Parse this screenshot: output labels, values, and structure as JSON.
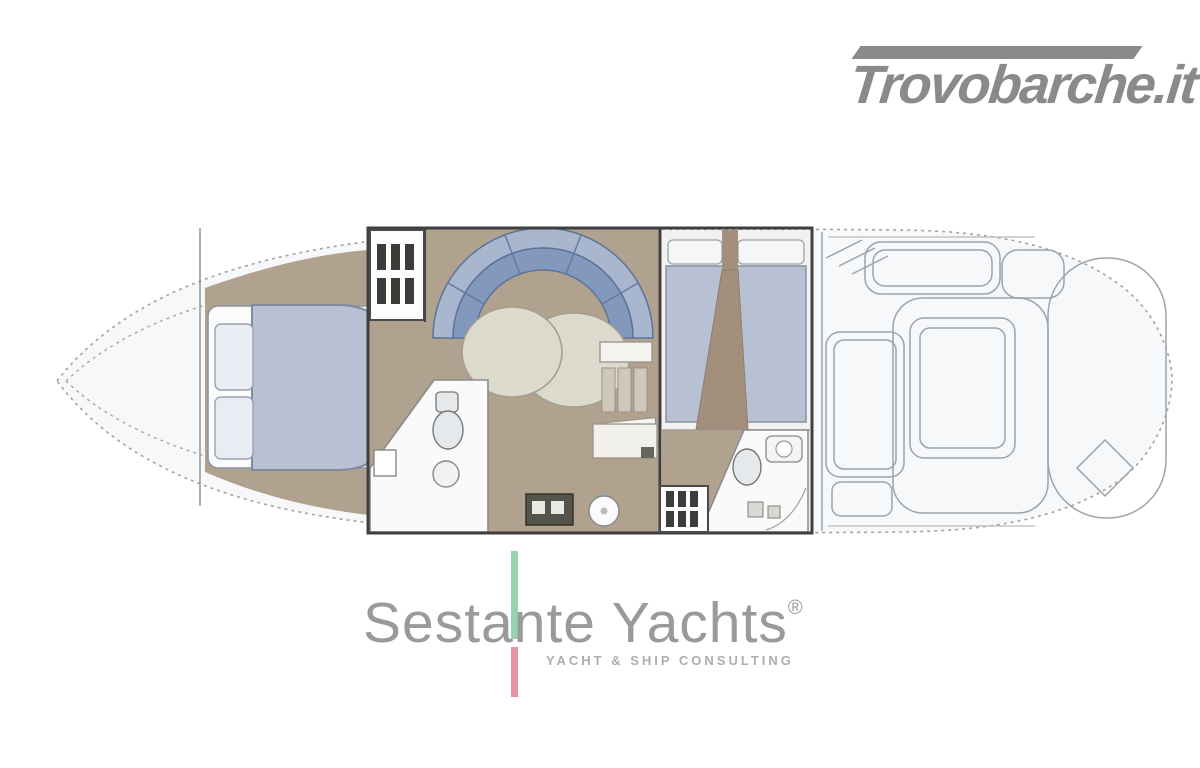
{
  "header": {
    "logo_text": "Trovobarche.it",
    "logo_color": "#8a8a8a"
  },
  "floorplan": {
    "type": "motor-yacht-deck-plan",
    "zones": [
      "bow-deck",
      "forward-cabin-double-berth",
      "salon-u-dinette-with-table",
      "forward-head",
      "galley",
      "companionway-steps",
      "mid-cabin-twin-berths",
      "aft-head",
      "cockpit-seating",
      "engine-hatch-sunpad",
      "stern-swim-platform"
    ],
    "colors": {
      "hull_fill": "#f7f8f9",
      "outline": "#a3a3a3",
      "wall": "#3f3f3f",
      "line": "#9ba3ac",
      "floor_tan": "#b0a28f",
      "floor_tan_dark": "#a2907c",
      "upholstery_blue": "#8298bc",
      "upholstery_blue_light": "#a8b6ce",
      "mattress_blue": "#b8c0d4",
      "pillow": "#e9edf3",
      "table_cream": "#dcdacd",
      "fixture_white": "#fafafa",
      "fixture_gray": "#e6e9ec",
      "cabinet_tan": "#cfc8ba",
      "stove_dark": "#55544a",
      "grid_dark": "#3c3c38",
      "midcabin_floor": "#f2f1ef"
    }
  },
  "footer": {
    "brand_text": "Sestante Yachts",
    "brand_mark": "®",
    "brand_color": "#9a9a9a",
    "tagline": "YACHT & SHIP CONSULTING",
    "tagline_color": "#aeaeae",
    "accent_green": "#98d3ac",
    "accent_red": "#e795a1"
  }
}
